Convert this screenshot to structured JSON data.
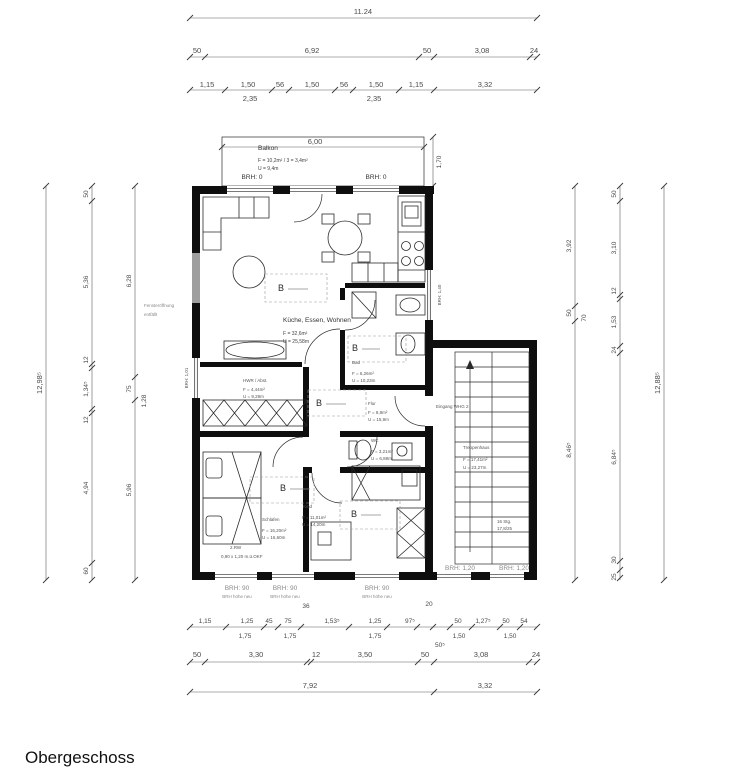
{
  "title": "Obergeschoss",
  "balcony": {
    "label": "Balkon",
    "area": "F = 10,2m² / 3 = 3,4m²",
    "perimeter": "U = 9,4m",
    "width": "6,00",
    "depth": "1,70",
    "brh_left": "BRH: 0",
    "brh_right": "BRH: 0"
  },
  "rooms": {
    "living": {
      "name": "Küche, Essen, Wohnen",
      "area": "F = 32,6m²",
      "perimeter": "U = 25,58m"
    },
    "bad": {
      "name": "Bad",
      "area": "F = 6,26m²",
      "perimeter": "U = 10,23m"
    },
    "flur": {
      "name": "Flur",
      "area": "F = 8,9m²",
      "perimeter": "U = 15,9m"
    },
    "wc": {
      "name": "WC",
      "area": "F = 3,21m²",
      "perimeter": "U = 6,88m"
    },
    "hwr": {
      "name": "HWR / Abst.",
      "area": "F = 4,44m²",
      "perimeter": "U = 9,29m"
    },
    "schlafen": {
      "name": "Schlafen",
      "area": "F = 16,20m²",
      "perimeter": "U = 16,60m"
    },
    "kind": {
      "name": "Kind",
      "area": "F = 11,01m²",
      "perimeter": "U = 14,20m"
    },
    "treppenhaus": {
      "name": "Treppenhaus",
      "area": "F = 17,41m²",
      "perimeter": "U = 23,27m"
    }
  },
  "annotations": {
    "entrance": "Eingang WHG 2",
    "window_removed_1": "Fensteröffnung",
    "window_removed_2": "entfällt",
    "rw_line1": "2.RW",
    "rw_line2": "0,90 x 1,20 m.ü.OKF",
    "stairs_note1": "16 Stg.",
    "stairs_note2": "17,8/25",
    "b_mark": "B",
    "brh_101": "BRH: 1,01",
    "brh_140": "BRH: 1,40",
    "brh_90": "BRH: 90",
    "brh_90_sub": "BRH höhe neu",
    "brh_120": "BRH: 1,20"
  },
  "dims": {
    "top_total": "11.24",
    "top_row2": [
      "50",
      "6,92",
      "50",
      "3,08",
      "24"
    ],
    "top_row3": [
      "1,15",
      "1,50",
      "56",
      "1,50",
      "56",
      "1,50",
      "1,15",
      "3,32"
    ],
    "top_row3_sub": [
      "2,35",
      "2,35"
    ],
    "left_total": "12,98⁵",
    "left_outer": [
      "50",
      "5,36",
      "12",
      "1,34⁵",
      "12",
      "4,94",
      "60"
    ],
    "left_inner": [
      "6,28",
      "75",
      "1,28",
      "5,96"
    ],
    "right_total": "12,88⁵",
    "right_outer": [
      "50",
      "3,10",
      "12",
      "1,53",
      "24",
      "6,84⁵",
      "30",
      "25"
    ],
    "right_inner": [
      "3,92",
      "50",
      "70",
      "8,46⁵"
    ],
    "bottom_t36": "36",
    "bottom_t20": "20",
    "bottom_row1": [
      "1,15",
      "1,25",
      "45",
      "75",
      "1,53⁵",
      "1,25",
      "97⁵",
      "50",
      "1,27⁵",
      "50",
      "54"
    ],
    "bottom_row1_sub": [
      "1,75",
      "1,75",
      "1,75",
      "50⁵",
      "1,50",
      "1,50"
    ],
    "bottom_row2": [
      "50",
      "3,30",
      "12",
      "3,50",
      "50",
      "3,08",
      "24"
    ],
    "bottom_row3": [
      "7,92",
      "3,32"
    ]
  },
  "colors": {
    "wall": "#0e0e0e",
    "removed_window_gray": "#9e9e9e"
  }
}
